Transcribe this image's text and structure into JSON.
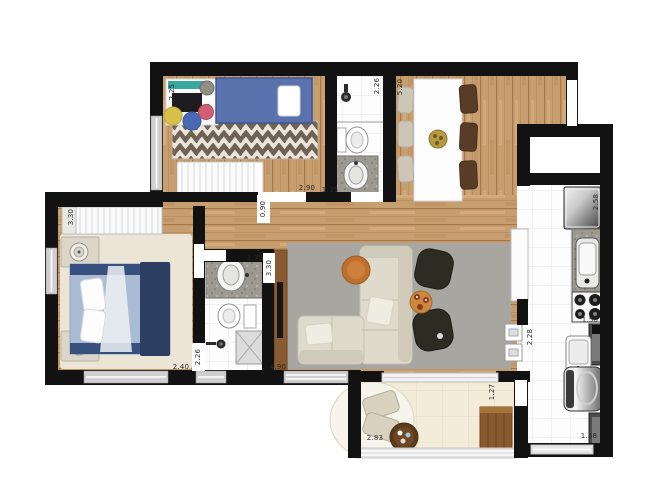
{
  "plan": {
    "type": "apartment-floor-plan",
    "dimensions": [
      "2.25",
      "2.90",
      "1.35",
      "2.26",
      "5.20",
      "3.30",
      "0.90",
      "1.35",
      "3.30",
      "2.40",
      "2.26",
      "4.90",
      "2.58",
      "1.50",
      "2.28",
      "1.27",
      "2.83",
      "1.58"
    ],
    "colors": {
      "wall": "#121212",
      "wood_floor": "#c79e70",
      "tile_floor": "#fdfdfd",
      "balcony_floor": "#f2ecd9",
      "living_rug": "#a8a6a1",
      "bedroom_rug": "#ece5d6",
      "chevron_rug_dark": "#6e6156",
      "kids_bed_blue": "#5872ad",
      "master_bed_blue": "#a9bcd4",
      "headboard_navy": "#2c3f63",
      "sofa_beige": "#dedacc",
      "ottoman_dark": "#2e2b23",
      "wood_furniture": "#8a5a30",
      "granite": "#9b9990",
      "accent_orange": "#c0702e",
      "accent_gold": "#b59a42",
      "pouf_yellow": "#d6c04a",
      "pouf_blue": "#4a69b5",
      "pouf_pink": "#d05f72"
    },
    "rooms": [
      {
        "name": "kids-bedroom",
        "furniture": [
          "single-bed",
          "desk",
          "desk-chair",
          "chevron-rug",
          "poufs",
          "wardrobe"
        ]
      },
      {
        "name": "bathroom-top",
        "furniture": [
          "shower",
          "toilet",
          "sink-counter"
        ]
      },
      {
        "name": "dining-room",
        "furniture": [
          "dining-table",
          "dark-chairs",
          "light-chairs",
          "centerpiece"
        ]
      },
      {
        "name": "master-bedroom",
        "furniture": [
          "double-bed",
          "wardrobe",
          "nightstands",
          "lamps",
          "rug"
        ]
      },
      {
        "name": "bathroom-center",
        "furniture": [
          "shower",
          "toilet",
          "sink-counter"
        ]
      },
      {
        "name": "living-room",
        "furniture": [
          "corner-sofa",
          "tv-panel",
          "ottomans",
          "side-tables",
          "rug"
        ]
      },
      {
        "name": "kitchen",
        "furniture": [
          "fridge",
          "counter-sink",
          "stove",
          "counter"
        ]
      },
      {
        "name": "laundry",
        "furniture": [
          "washing-machine",
          "laundry-sink",
          "cabinets"
        ]
      },
      {
        "name": "balcony",
        "furniture": [
          "lounge-chairs",
          "round-table",
          "wood-bench",
          "rug",
          "railing"
        ]
      }
    ]
  }
}
